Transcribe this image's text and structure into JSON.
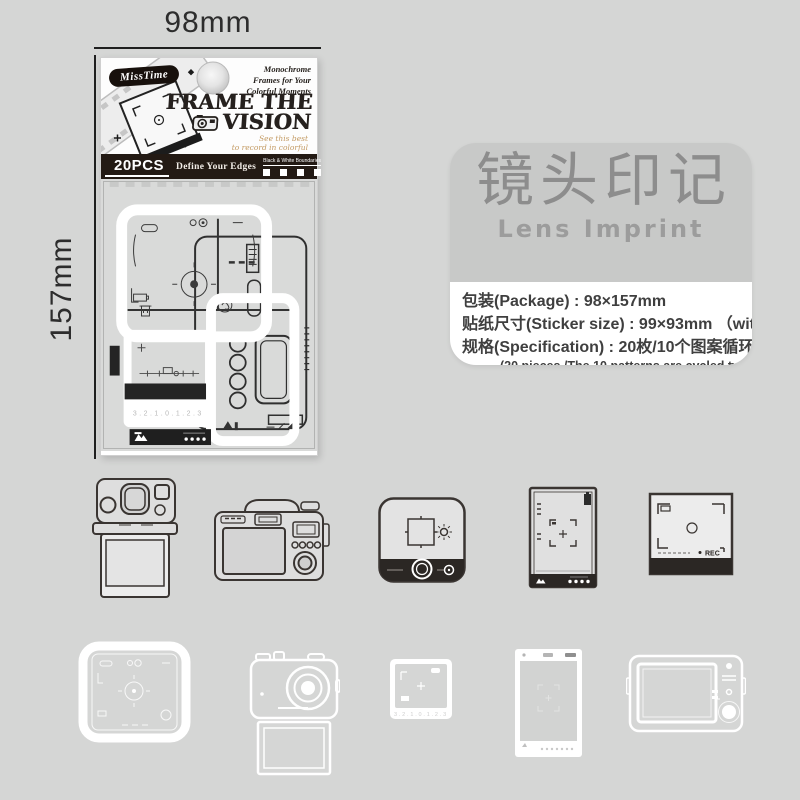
{
  "canvas": {
    "bg": "#d5d6d5"
  },
  "dimension_labels": {
    "width": "98mm",
    "height": "157mm"
  },
  "package": {
    "brand": "MissTime",
    "tagline": [
      "Monochrome",
      "Frames for Your",
      "Colorful Moments"
    ],
    "title": [
      "FRAME THE",
      "VISION"
    ],
    "script": [
      "See this best",
      "to record in colorful"
    ],
    "count": "20PCS",
    "slogan": "Define Your Edges",
    "boundaries": "Black & White Boundaries",
    "bar_color": "#231a14",
    "sheet_numbers": "3.2.1.0.1.2.3"
  },
  "info_panel": {
    "title_cn": "镜头印记",
    "title_en": "Lens Imprint",
    "spec_lines": [
      "包装(Package) : 98×157mm",
      "贴纸尺寸(Sticker size) : 99×93mm （with in)",
      "规格(Specification) : 20枚/10个图案循环2次"
    ],
    "spec_note": "(20 pieces /The 10 patterns are cycled twice)",
    "header_bg": "#c8c9c8",
    "body_bg": "#ffffff",
    "title_color": "#8d8d8d"
  },
  "stickers": {
    "row1": [
      "instant-camera-icon",
      "compact-camera-back-icon",
      "rounded-camera-front-icon",
      "viewfinder-card-portrait-icon",
      "viewfinder-card-square-icon"
    ],
    "row2": [
      "white-rounded-frame-icon",
      "white-camera-with-photo-icon",
      "white-photo-frame-icon",
      "white-portrait-frame-icon",
      "white-camera-back-icon"
    ],
    "rec_label": "REC",
    "frame_numbers": "3.2.1.0.1.2.3"
  }
}
